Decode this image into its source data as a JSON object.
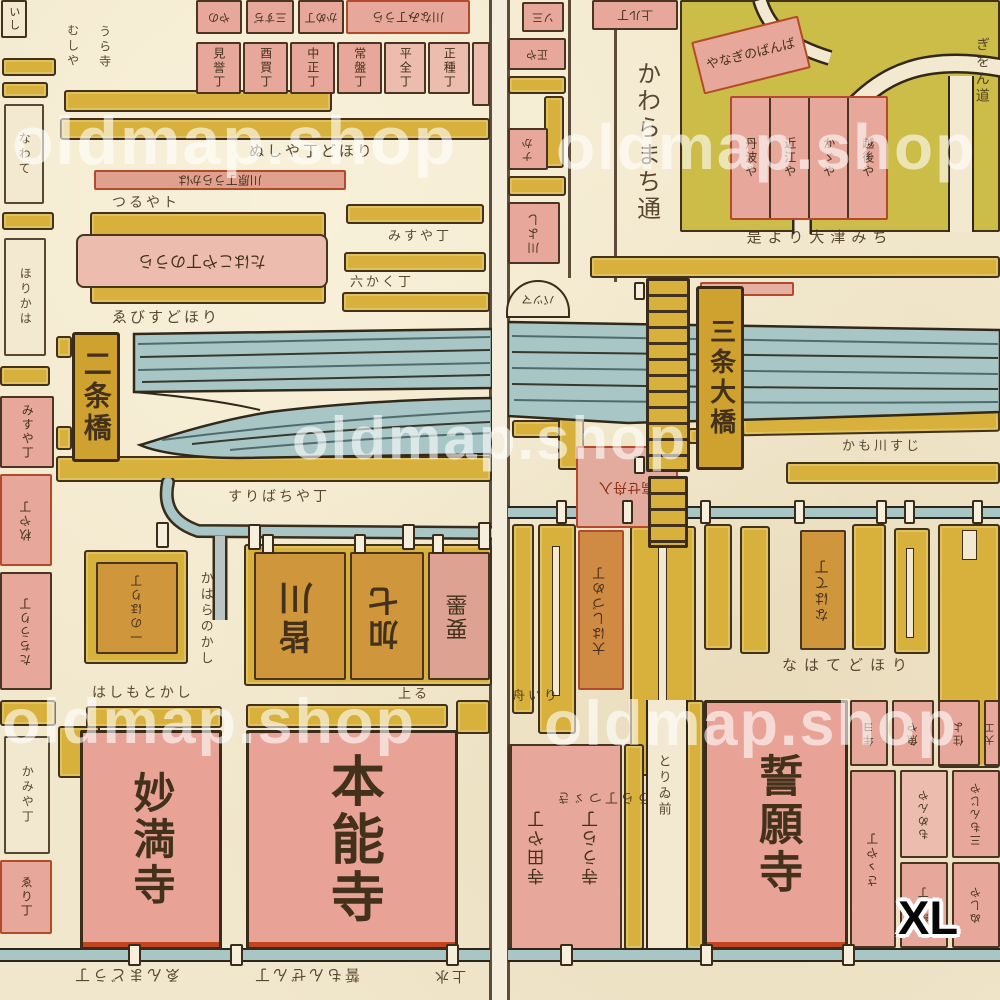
{
  "watermark": {
    "text": "oldmap.shop"
  },
  "badge": {
    "text": "XL"
  },
  "colors": {
    "paper": "#f1e7cc",
    "street_yellow": "#d7b13c",
    "field_yellow": "#ccbd49",
    "block_pink": "#e7a79b",
    "block_orange": "#d0963c",
    "river_teal": "#a9c6c6",
    "ink": "#3e2e1d",
    "red_accent": "#c44a26",
    "watermark_white": "#ffffff"
  },
  "left_page": {
    "bridge_label": "二条橋",
    "temple_myomanji": "妙満寺",
    "temple_honnoji": "本能寺",
    "top_partial_cells": [
      "やの",
      "三すぢ",
      "かめ丁"
    ],
    "top_corner_block": "川なみ丁うら",
    "town_row": [
      "見誉丁",
      "酉買丁",
      "中正丁",
      "常盤丁",
      "平全丁",
      "正種丁"
    ],
    "left_texts": [
      "むしや",
      "うら寺"
    ],
    "row_note_1": "ぬしや丁どほり",
    "pink_bar": "川原丁うらかは",
    "row_note_2": "つるやト",
    "big_pink_label": "たはこや丁のうら",
    "row_note_3": "みすや丁",
    "row_note_4": "六かく丁",
    "row_note_5": "ゑびすどほり",
    "street_note": "すりばちや丁",
    "canal_street_label": "かはらのかし",
    "small_orange_label": "一のほり丁",
    "orange_blocks": [
      "皆川",
      "加七",
      "要墨"
    ],
    "pre_temple_note": "はしもとかし",
    "pre_temple_note2": "上る",
    "edge_texts": [
      "いし",
      "なわて",
      "ほりかは",
      "みすや丁",
      "杦や丁",
      "たちうり丁",
      "かみや丁",
      "ゑり丁"
    ],
    "bottom_notes": [
      "ゑんまどう丁",
      "誓もんぜん丁",
      "上水"
    ]
  },
  "right_page": {
    "bridge_label": "三条大橋",
    "temple_seiganji": "誓願寺",
    "road_label": "かわらまち通",
    "corner_note": "ぎをん道",
    "edge_cells": [
      "ソ三",
      "正や",
      "ナか",
      "川よし"
    ],
    "boat_label": "バツマ",
    "top_cell": "上ル丁",
    "road_cursive": "やなぎのばんば",
    "pink_quad": [
      "丹波や",
      "近江や",
      "かゞや",
      "越後や"
    ],
    "road_note": "是より大津みち",
    "below_river_note": "かも川すじ",
    "funairi_label": "高せ舟入",
    "stall_label_1": "大はしづめ丁",
    "stall_label_2": "なはて丁",
    "stall_note": "なはてどほり",
    "note_funairi": "舟いり",
    "note_ura": "うら丁つゞき",
    "street_label": "とりゐ前",
    "teramachi_cells": [
      "寺田や丁",
      "寺うら丁"
    ],
    "grid_row1": [
      "年ヨ",
      "魚や",
      "住よ",
      "大工"
    ],
    "grid_row2": [
      "さゝや丁",
      "もめんや",
      "三もんじや"
    ],
    "grid_row3": [
      "紙や丁",
      "ぬしや"
    ]
  }
}
